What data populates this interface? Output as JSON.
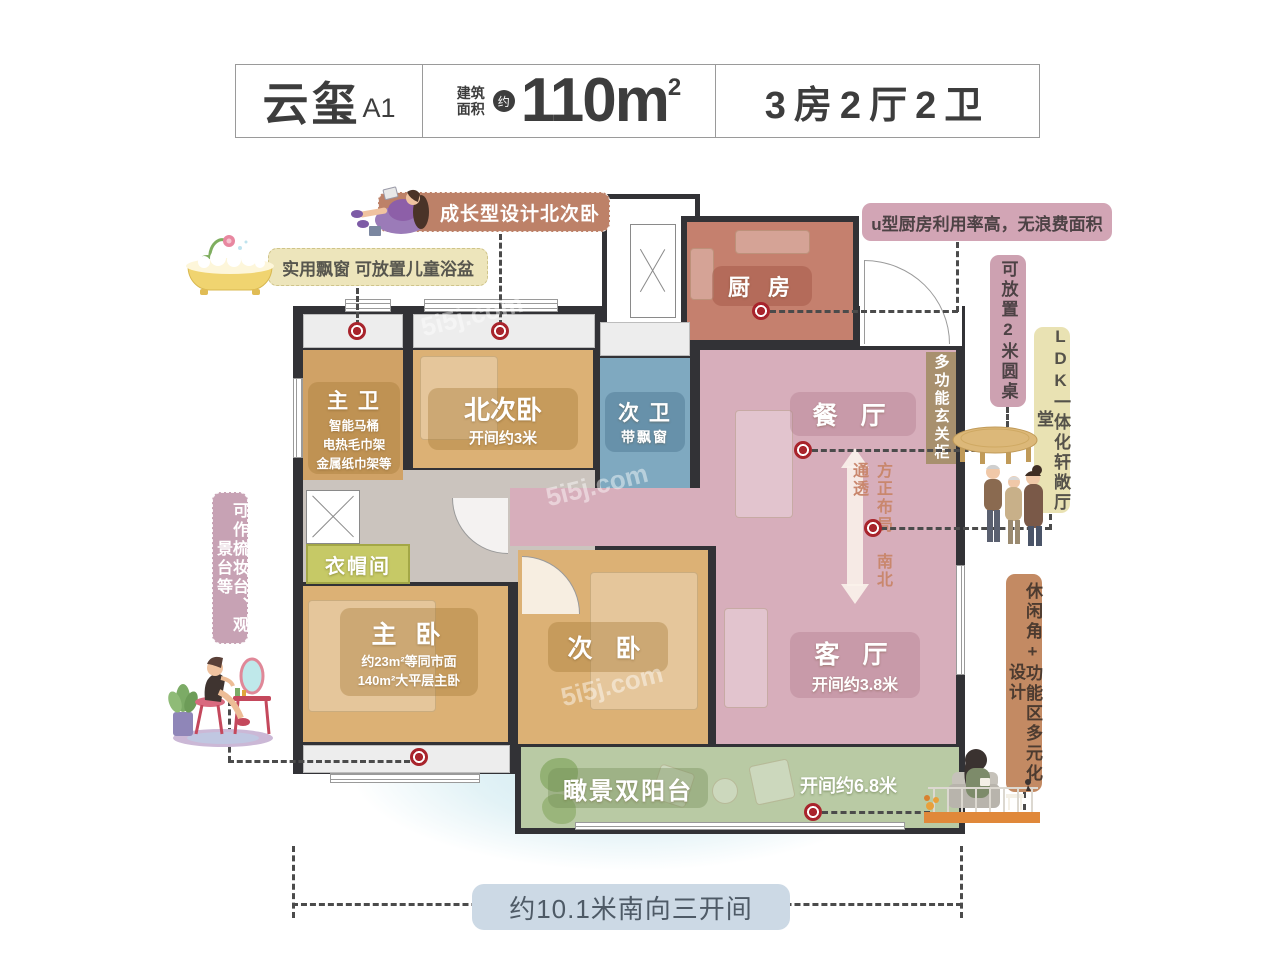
{
  "header": {
    "project_name": "云玺",
    "unit_label": "A1",
    "area_label_line1": "建筑",
    "area_label_line2": "面积",
    "area_approx": "约",
    "area_value": "110m",
    "area_exponent": "2",
    "layout_summary": "3房2厅2卫"
  },
  "rooms": {
    "master_bath": {
      "name": "主 卫",
      "features": [
        "智能马桶",
        "电热毛巾架",
        "金属纸巾架等"
      ]
    },
    "north_bedroom": {
      "name": "北次卧",
      "dimension": "开间约3米"
    },
    "second_bath": {
      "name": "次 卫",
      "feature": "带飘窗"
    },
    "kitchen": {
      "name": "厨 房"
    },
    "dining_room": {
      "name": "餐 厅"
    },
    "cloakroom": {
      "name": "衣帽间"
    },
    "master_bedroom": {
      "name": "主 卧",
      "desc_line1": "约23m²等同市面",
      "desc_line2": "140m²大平层主卧"
    },
    "second_bedroom": {
      "name": "次 卧"
    },
    "living_room": {
      "name": "客 厅",
      "dimension": "开间约3.8米"
    },
    "balcony": {
      "name": "瞰景双阳台",
      "dimension": "开间约6.8米"
    },
    "foyer_cabinet": {
      "name": "多功能玄关柜"
    }
  },
  "callouts": {
    "north_bedroom_note": "成长型设计北次卧",
    "bay_window_note": "实用飘窗 可放置儿童浴盆",
    "kitchen_note": "u型厨房利用率高，无浪费面积",
    "round_table_note": "可放置2米圆桌",
    "ldk_note": "LDK一体化轩敞厅堂",
    "layout_axis_note": "方正布局 南北通透",
    "vanity_note": "可作梳妆台、观景台等",
    "leisure_note": "休闲角+功能区多元化设计",
    "south_facing_note": "约10.1米南向三开间"
  },
  "watermark": "5i5j.com",
  "colors": {
    "wall": "#323236",
    "bedroom_tan": "#dcb175",
    "bath_blue": "#7fa9c0",
    "kitchen_salmon": "#c5806e",
    "living_pink": "#d7aebb",
    "balcony_green": "#b9caa4",
    "accent_red": "#a8242c"
  }
}
